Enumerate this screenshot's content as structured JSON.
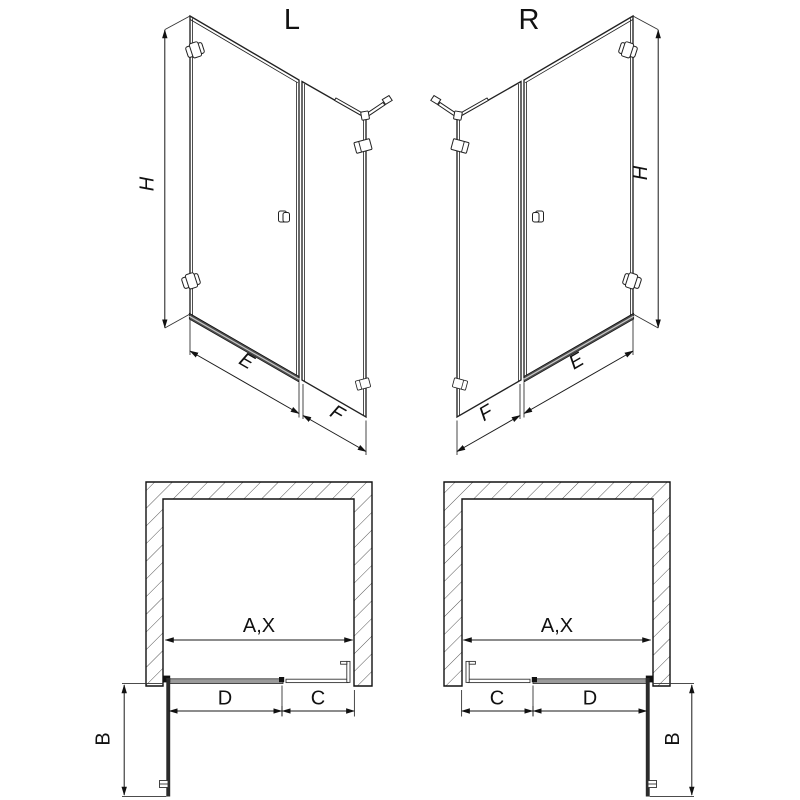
{
  "views": {
    "elevation_left": {
      "label": "L",
      "dim_height": "H",
      "dim_door_width": "E",
      "dim_panel_width": "F"
    },
    "elevation_right": {
      "label": "R",
      "dim_height": "H",
      "dim_door_width": "E",
      "dim_panel_width": "F"
    },
    "plan_left": {
      "dim_opening": "A,X",
      "dim_door": "D",
      "dim_panel": "C",
      "dim_swing": "B"
    },
    "plan_right": {
      "dim_opening": "A,X",
      "dim_door": "D",
      "dim_panel": "C",
      "dim_swing": "B"
    }
  },
  "colors": {
    "line": "#222222",
    "dim_line": "#1a1a1a",
    "door_closed_gray": "#9a9a9a",
    "threshold_fill": "#4d4d4d",
    "threshold_stripe": "#c8c8c8",
    "open_door_dark": "#2b2b2b",
    "background": "#ffffff"
  }
}
